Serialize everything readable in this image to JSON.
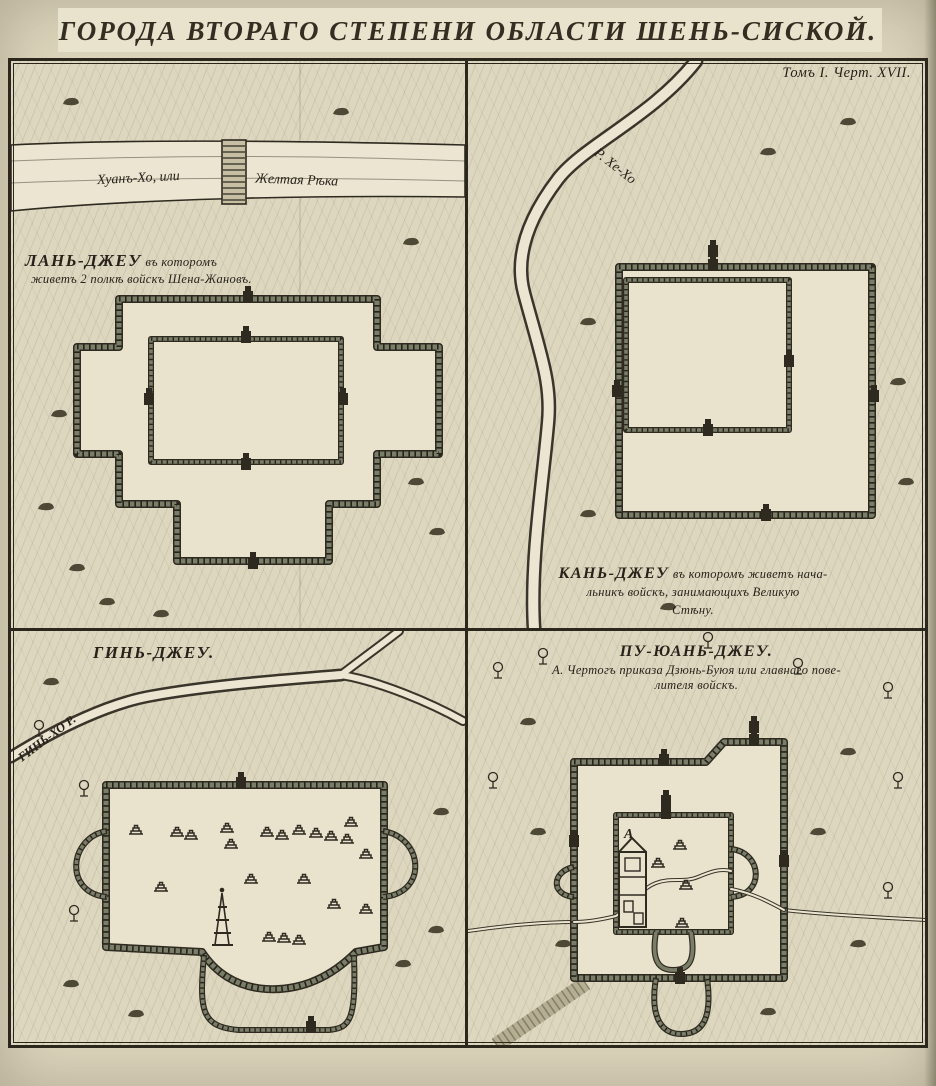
{
  "title": "ГОРОДА ВТОРАГО СТЕПЕНИ ОБЛАСТИ ШЕНЬ-СИСКОЙ.",
  "plate_ref": "Томъ I. Черт. XVII.",
  "colors": {
    "paper": "#ded7bf",
    "ink": "#2b271d",
    "wall": "#7a7d68",
    "water": "#ebe5d1"
  },
  "panels": {
    "lan": {
      "name": "ЛАНЬ-ДЖЕУ",
      "name_note": "въ которомъ",
      "caption": "живетъ 2 полкѣ войскъ Шена-Жановъ.",
      "river_left": "Хуанъ-Хо, или",
      "river_right": "Желтая Рѣка"
    },
    "kan": {
      "river": "Р. Хе-Хо",
      "cap1_big": "КАНЬ-ДЖЕУ",
      "cap1_rest": "въ которомъ живетъ нача-",
      "cap2": "льникъ войскъ, занимающихъ Великую",
      "cap3": "Стѣну."
    },
    "gin": {
      "title": "ГИНЬ-ДЖЕУ.",
      "river": "ГИНЬ-ХО Р."
    },
    "pu": {
      "title": "ПУ-ЮАНЬ-ДЖЕУ.",
      "cap1": "А. Чертогъ приказа Дзюнь-Буюя или главнаго пове-",
      "cap2": "лителя войскъ.",
      "marker_a": "А"
    }
  }
}
